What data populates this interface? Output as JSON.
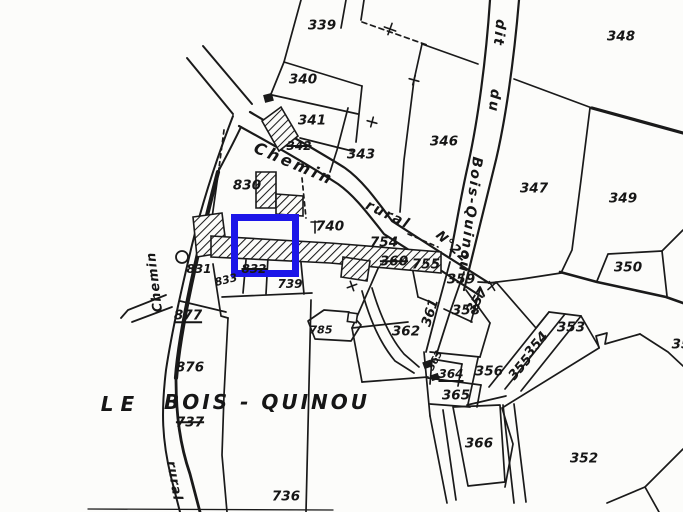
{
  "map": {
    "ink_color": "#1a1a1a",
    "paper_color": "#fcfcfa",
    "place_name": "LE BOIS - QUINOU"
  },
  "highlight": {
    "x": 231,
    "y": 214,
    "w": 68,
    "h": 63,
    "border": 7,
    "color": "#1c16e8"
  },
  "labels": [
    {
      "text": "339",
      "x": 322,
      "y": 26
    },
    {
      "text": "340",
      "x": 303,
      "y": 80
    },
    {
      "text": "341",
      "x": 312,
      "y": 121
    },
    {
      "text": "342",
      "x": 299,
      "y": 146,
      "strike": true,
      "size": 12
    },
    {
      "text": "343",
      "x": 361,
      "y": 155
    },
    {
      "text": "346",
      "x": 444,
      "y": 142
    },
    {
      "text": "347",
      "x": 534,
      "y": 189
    },
    {
      "text": "348",
      "x": 621,
      "y": 37
    },
    {
      "text": "349",
      "x": 623,
      "y": 199
    },
    {
      "text": "350",
      "x": 628,
      "y": 268
    },
    {
      "text": "35",
      "x": 681,
      "y": 345
    },
    {
      "text": "352",
      "x": 584,
      "y": 459
    },
    {
      "text": "353",
      "x": 571,
      "y": 328
    },
    {
      "text": "354",
      "x": 537,
      "y": 345,
      "rot": -50
    },
    {
      "text": "355",
      "x": 521,
      "y": 368,
      "rot": -50
    },
    {
      "text": "356",
      "x": 489,
      "y": 372
    },
    {
      "text": "357",
      "x": 478,
      "y": 301,
      "rot": -58
    },
    {
      "text": "358",
      "x": 466,
      "y": 311
    },
    {
      "text": "359",
      "x": 461,
      "y": 280
    },
    {
      "text": "360",
      "x": 394,
      "y": 262,
      "strike": true
    },
    {
      "text": "361",
      "x": 431,
      "y": 313,
      "rot": -72
    },
    {
      "text": "362",
      "x": 406,
      "y": 332
    },
    {
      "text": "363",
      "x": 436,
      "y": 361,
      "rot": -62,
      "size": 10
    },
    {
      "text": "364",
      "x": 451,
      "y": 374,
      "underline": true,
      "size": 12
    },
    {
      "text": "365",
      "x": 456,
      "y": 396
    },
    {
      "text": "366",
      "x": 479,
      "y": 444
    },
    {
      "text": "736",
      "x": 286,
      "y": 497
    },
    {
      "text": "737",
      "x": 190,
      "y": 423,
      "strike": true
    },
    {
      "text": "739",
      "x": 290,
      "y": 284,
      "size": 12
    },
    {
      "text": "740",
      "x": 330,
      "y": 227
    },
    {
      "text": "754",
      "x": 384,
      "y": 243
    },
    {
      "text": "755",
      "x": 426,
      "y": 265
    },
    {
      "text": "785",
      "x": 321,
      "y": 330,
      "size": 11
    },
    {
      "text": "830",
      "x": 247,
      "y": 186
    },
    {
      "text": "831",
      "x": 199,
      "y": 269,
      "size": 12
    },
    {
      "text": "832",
      "x": 254,
      "y": 269,
      "strike": true,
      "size": 12
    },
    {
      "text": "833",
      "x": 226,
      "y": 280,
      "rot": -14,
      "size": 11
    },
    {
      "text": "876",
      "x": 190,
      "y": 368
    },
    {
      "text": "877",
      "x": 188,
      "y": 316,
      "underline": true
    },
    {
      "text": "LE",
      "x": 121,
      "y": 404,
      "kind": "place",
      "size": 20,
      "ls": 7
    },
    {
      "text": "BOIS - QUINOU",
      "x": 267,
      "y": 402,
      "kind": "place",
      "size": 20,
      "ls": 3
    },
    {
      "text": "Chemin",
      "x": 294,
      "y": 164,
      "kind": "road",
      "rot": 23,
      "size": 16,
      "ls": 3
    },
    {
      "text": "rural",
      "x": 388,
      "y": 215,
      "kind": "road",
      "rot": 26,
      "size": 14,
      "ls": 2
    },
    {
      "text": "N°22",
      "x": 452,
      "y": 247,
      "kind": "road",
      "rot": 43,
      "size": 13,
      "ls": 1
    },
    {
      "text": "dit",
      "x": 499,
      "y": 33,
      "kind": "road",
      "rot": 96,
      "size": 14,
      "ls": 2
    },
    {
      "text": "du",
      "x": 494,
      "y": 101,
      "kind": "road",
      "rot": 96,
      "size": 14,
      "ls": 2
    },
    {
      "text": "Bois-Quinou",
      "x": 470,
      "y": 215,
      "kind": "road",
      "rot": 97,
      "size": 14,
      "ls": 2
    },
    {
      "text": "Chemin",
      "x": 155,
      "y": 282,
      "kind": "road",
      "rot": -97,
      "size": 13,
      "ls": 1
    },
    {
      "text": "rural",
      "x": 174,
      "y": 481,
      "kind": "road",
      "rot": 80,
      "size": 13,
      "ls": 1
    }
  ]
}
